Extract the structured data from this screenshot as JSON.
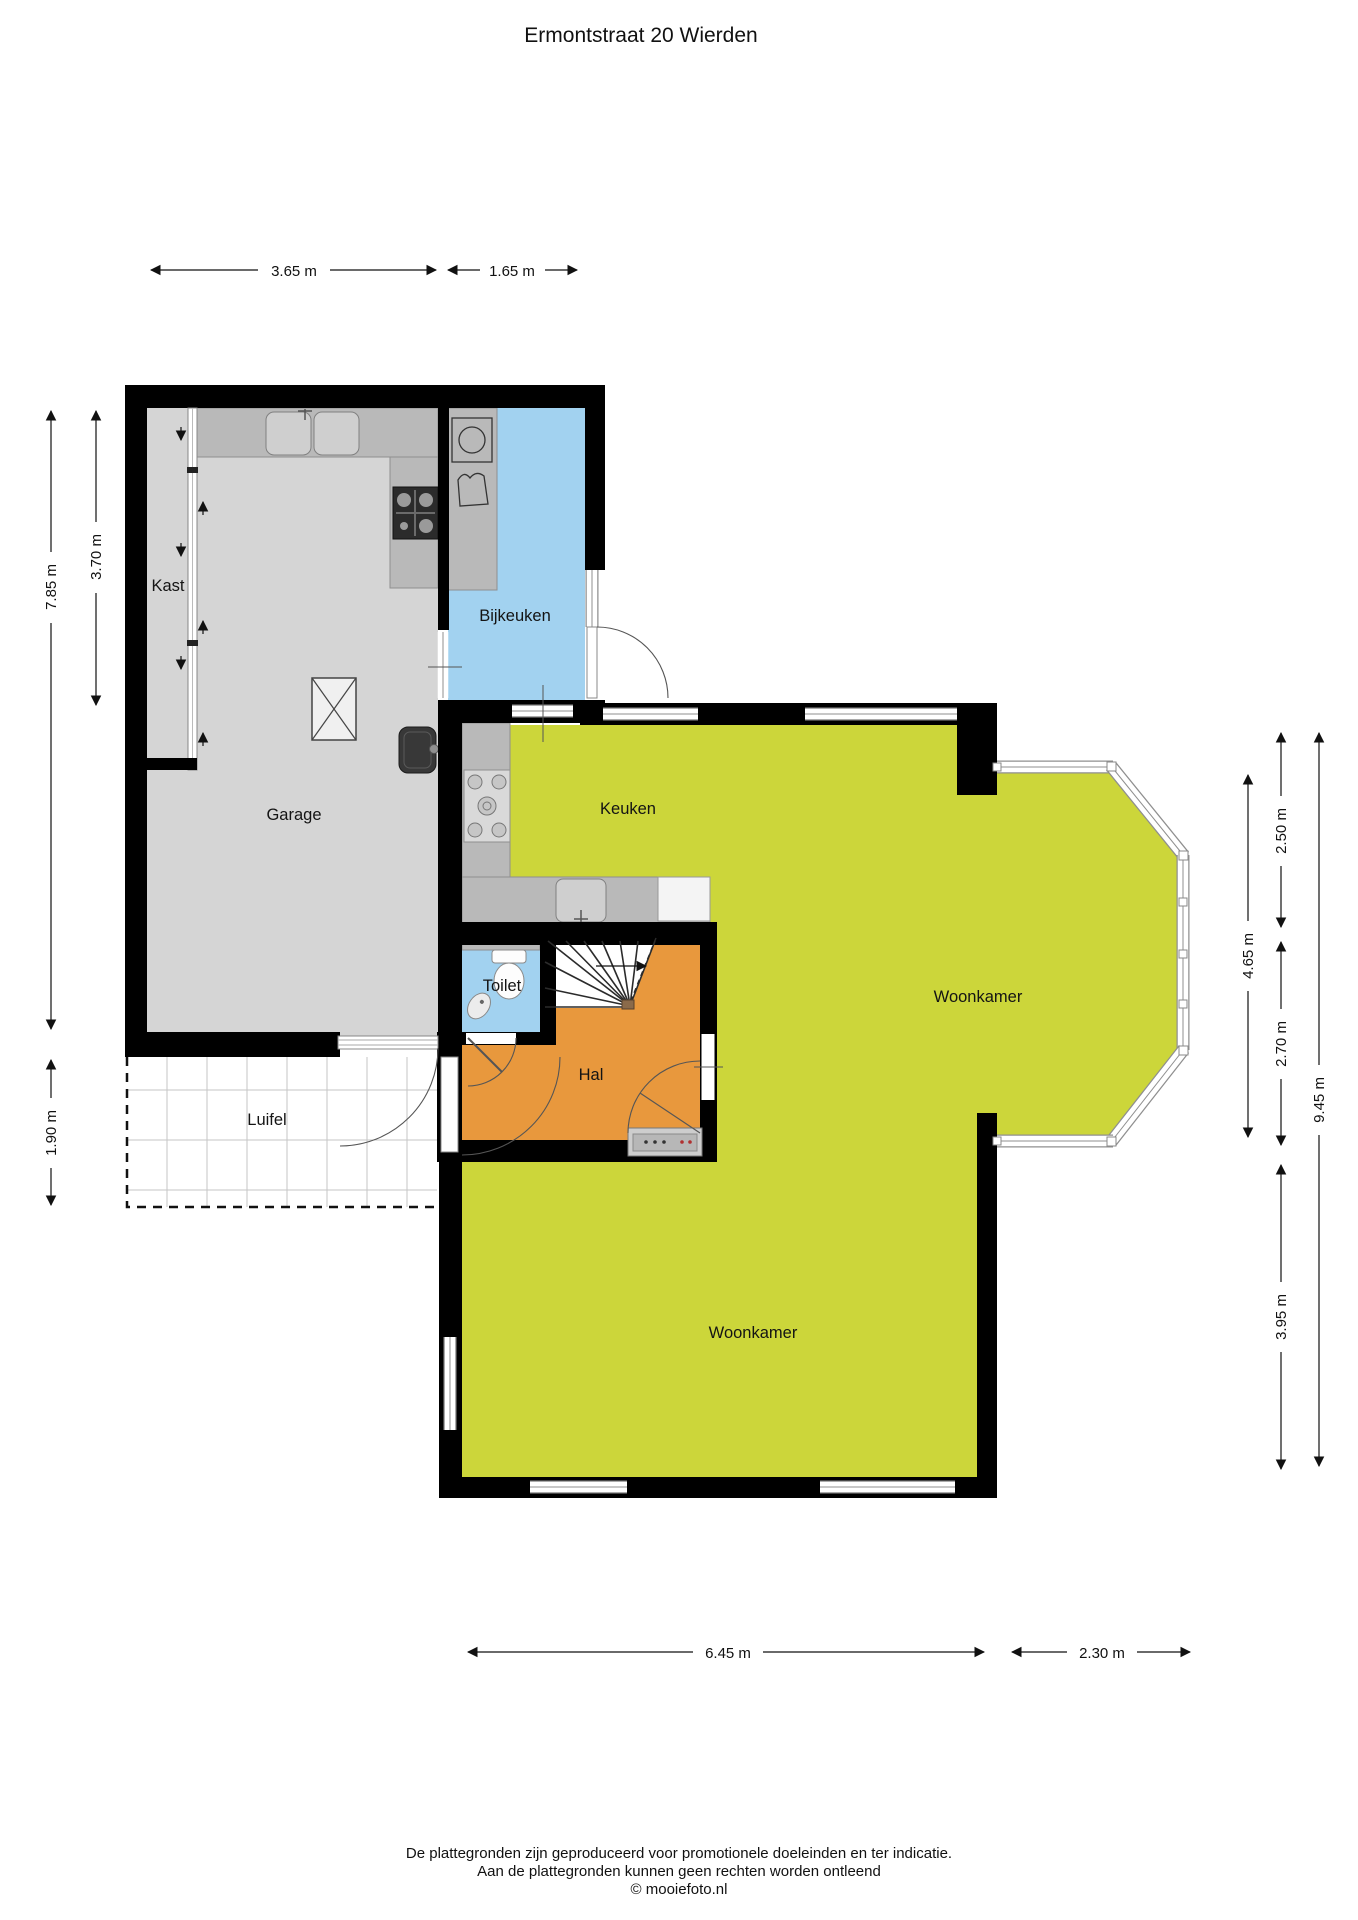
{
  "title": "Ermontstraat 20 Wierden",
  "rooms": {
    "kast": "Kast",
    "garage": "Garage",
    "bijkeuken": "Bijkeuken",
    "keuken": "Keuken",
    "toilet": "Toilet",
    "hal": "Hal",
    "luifel": "Luifel",
    "woonkamer_upper": "Woonkamer",
    "woonkamer_lower": "Woonkamer"
  },
  "dimensions": {
    "top_garage": "3.65 m",
    "top_bijkeuken": "1.65 m",
    "left_kast": "3.70 m",
    "left_garage": "7.85 m",
    "left_luifel": "1.90 m",
    "right_upper": "2.50 m",
    "right_bay": "4.65 m",
    "right_hal": "2.70 m",
    "right_total": "9.45 m",
    "right_lower": "3.95 m",
    "bottom_main": "6.45 m",
    "bottom_bay": "2.30 m"
  },
  "footer": {
    "line1": "De plattegronden zijn geproduceerd voor promotionele doeleinden en ter indicatie.",
    "line2": "Aan de plattegronden kunnen geen rechten worden ontleend",
    "line3": "© mooiefoto.nl"
  },
  "colors": {
    "wall": "#000000",
    "floor_garage": "#d5d5d5",
    "floor_utility": "#a2d2f0",
    "floor_living": "#ccd63a",
    "floor_hall": "#e8983d",
    "floor_stairs": "#ffffff",
    "counter": "#b9b9b9",
    "appliance_dark": "#383838",
    "doormat": "#cdcdcd"
  }
}
